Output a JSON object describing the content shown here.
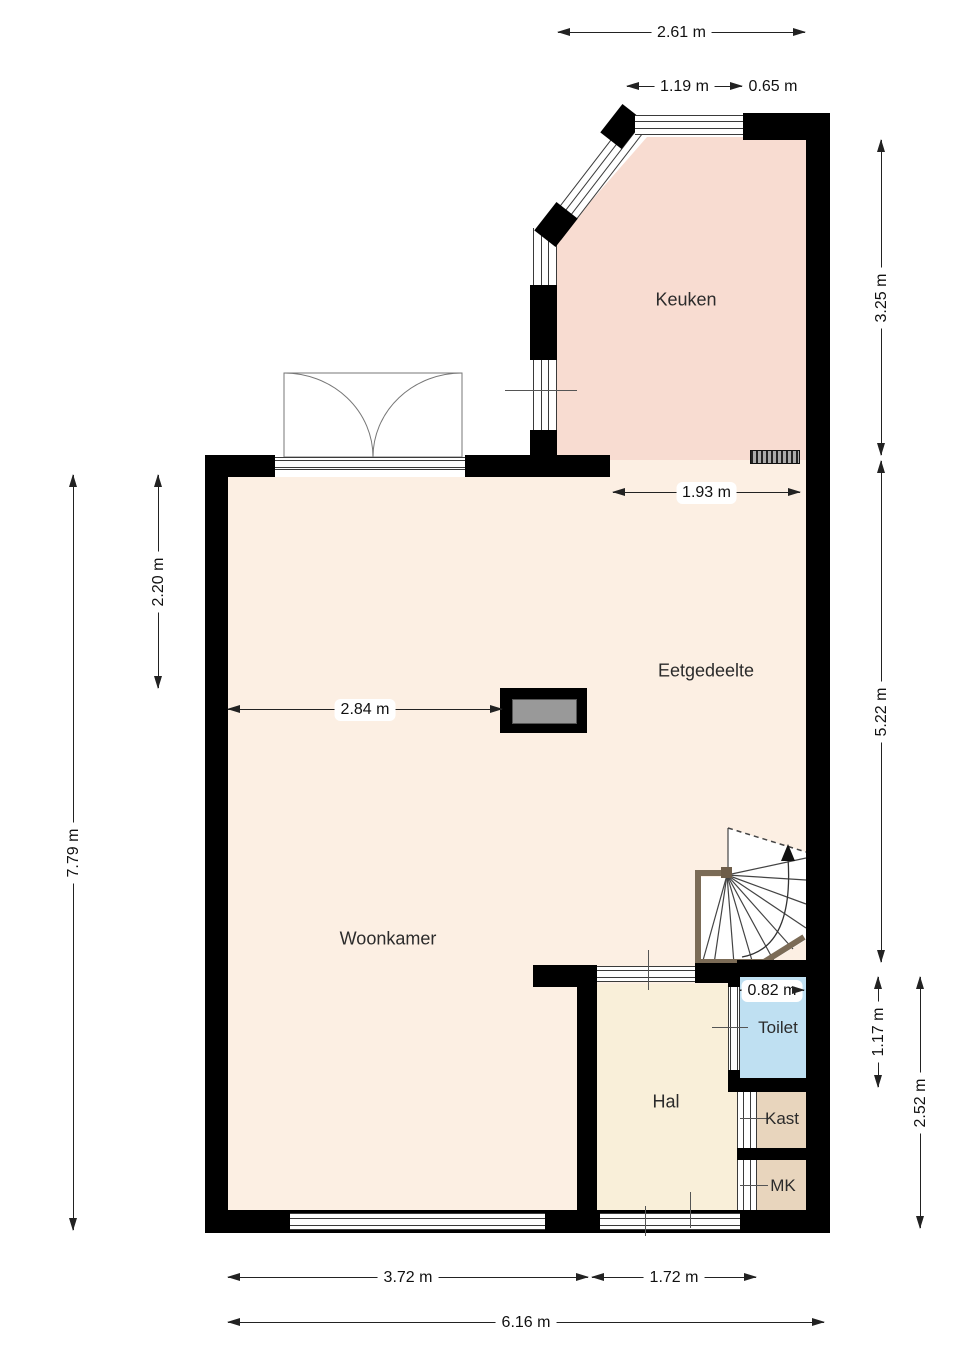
{
  "rooms": {
    "keuken": {
      "label": "Keuken"
    },
    "eetgedeelte": {
      "label": "Eetgedeelte"
    },
    "woonkamer": {
      "label": "Woonkamer"
    },
    "hal": {
      "label": "Hal"
    },
    "toilet": {
      "label": "Toilet"
    },
    "kast": {
      "label": "Kast"
    },
    "mk": {
      "label": "MK"
    }
  },
  "dimensions": {
    "top_total": {
      "label": "2.61 m"
    },
    "kitchen_window": {
      "label": "1.19 m"
    },
    "kitchen_wall": {
      "label": "0.65 m"
    },
    "kitchen_depth": {
      "label": "3.25 m"
    },
    "dining_depth": {
      "label": "5.22 m"
    },
    "toilet_depth": {
      "label": "1.17 m"
    },
    "hall_depth": {
      "label": "2.52 m"
    },
    "living_upper": {
      "label": "2.20 m"
    },
    "left_total": {
      "label": "7.79 m"
    },
    "dining_width": {
      "label": "1.93 m"
    },
    "living_width": {
      "label": "2.84 m"
    },
    "toilet_width": {
      "label": "0.82 m"
    },
    "living_window": {
      "label": "3.72 m"
    },
    "hall_width": {
      "label": "1.72 m"
    },
    "bottom_total": {
      "label": "6.16 m"
    }
  },
  "colors": {
    "kitchen": "#f8dcd1",
    "living": "#fcefe3",
    "hall": "#f9efd9",
    "toilet": "#bfe0f2",
    "closet": "#e8d5bd",
    "wall": "#000000",
    "wood": "#7b6b56",
    "dimension_line": "#222222"
  }
}
